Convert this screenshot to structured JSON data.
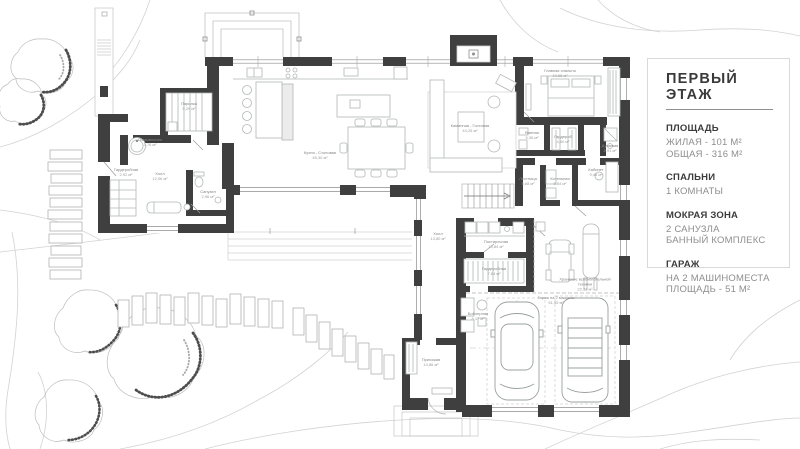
{
  "legend": {
    "title": "ПЕРВЫЙ ЭТАЖ",
    "sections": [
      {
        "header": "ПЛОЩАДЬ",
        "lines": [
          "ЖИЛАЯ - 101 М²",
          "ОБЩАЯ - 316 М²"
        ]
      },
      {
        "header": "СПАЛЬНИ",
        "lines": [
          "1 КОМНАТЫ",
          ""
        ]
      },
      {
        "header": "МОКРАЯ ЗОНА",
        "lines": [
          "2 САНУЗЛА",
          "БАННЫЙ КОМПЛЕКС"
        ]
      },
      {
        "header": "ГАРАЖ",
        "lines": [
          "НА 2 МАШИНОМЕСТА",
          "ПЛОЩАДЬ - 51 М²"
        ]
      }
    ]
  },
  "rooms": [
    {
      "name": "Парилка",
      "area": "5,29 м²"
    },
    {
      "name": "Помывочная",
      "area": "3,76 м²"
    },
    {
      "name": "Холл",
      "area": "12,06 м²"
    },
    {
      "name": "Гардеробная",
      "area": "2,92 м²"
    },
    {
      "name": "Санузел",
      "area": "2,96 м²"
    },
    {
      "name": "Кухня - Столовая",
      "area": "45,30 м²"
    },
    {
      "name": "Каминная - Гостиная",
      "area": "44,25 м²"
    },
    {
      "name": "Главная спальня",
      "area": "19,68 м²"
    },
    {
      "name": "Ванная",
      "area": "5,36 м²"
    },
    {
      "name": "Гардероб",
      "area": "4,60 м²"
    },
    {
      "name": "Душевая",
      "area": "2,91 м²"
    },
    {
      "name": "Кабинет",
      "area": "9,45 м²"
    },
    {
      "name": "Лестница",
      "area": "5,68 м²"
    },
    {
      "name": "Котельная",
      "area": "5,64 м²"
    },
    {
      "name": "Холл",
      "area": "13,80 м²"
    },
    {
      "name": "Постирочная",
      "area": "10,84 м²"
    },
    {
      "name": "Гардеробная",
      "area": "7,64 м²"
    },
    {
      "name": "Бойлерная",
      "area": "8,17 м²"
    },
    {
      "name": "Прихожая",
      "area": "10,86 м²"
    },
    {
      "name": "Хранение вспомогательной техники",
      "area": "22,77 м²"
    },
    {
      "name": "Гараж на 2 машины",
      "area": "51,55 м²"
    }
  ],
  "colors": {
    "wall": "#3f3f3f",
    "furniture": "#b2b8b6",
    "contour": "#d2d2d2",
    "label": "#8a8a8a",
    "panel_border": "#d9d9d9",
    "text_dark": "#3a3a3a",
    "text_gray": "#8e8e8e"
  }
}
